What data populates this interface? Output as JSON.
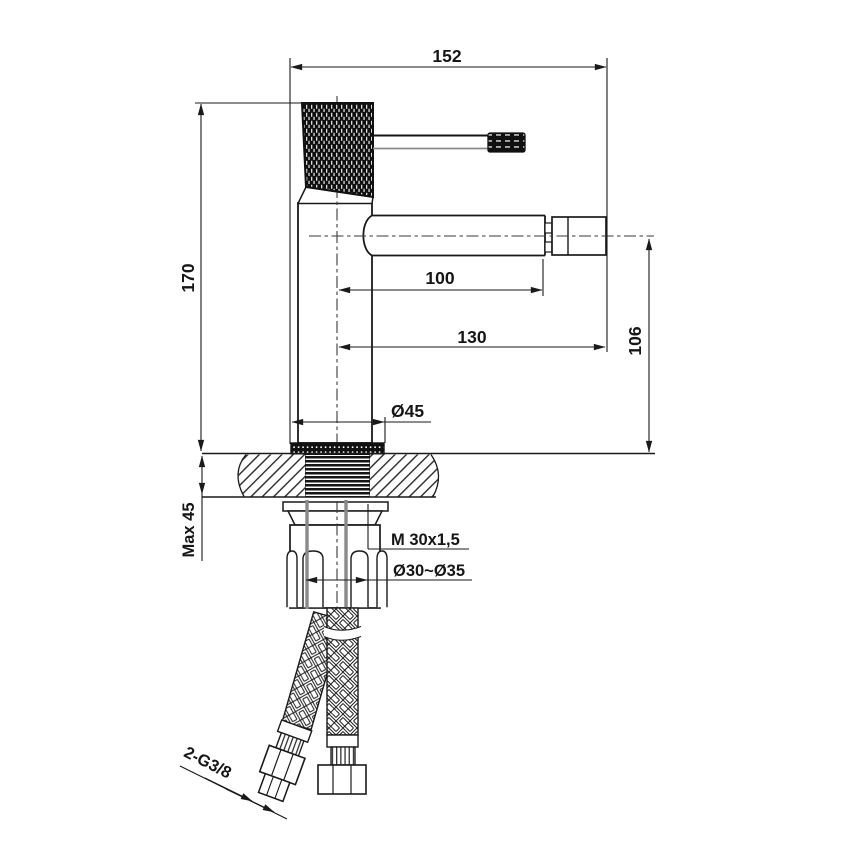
{
  "drawing": {
    "dims": {
      "overall_width": "152",
      "body_height": "170",
      "spout_reach": "100",
      "spout_overall_reach": "130",
      "spout_height": "106",
      "base_diameter": "Ø45",
      "max_deck_thickness": "Max 45",
      "mounting_thread": "M 30x1,5",
      "hole_diameter": "Ø30~Ø35",
      "hose_connections": "2-G3/8"
    }
  },
  "colors": {
    "line": "#1a1a1a",
    "background": "#ffffff",
    "hidden_gray": "#8a8a8a"
  }
}
